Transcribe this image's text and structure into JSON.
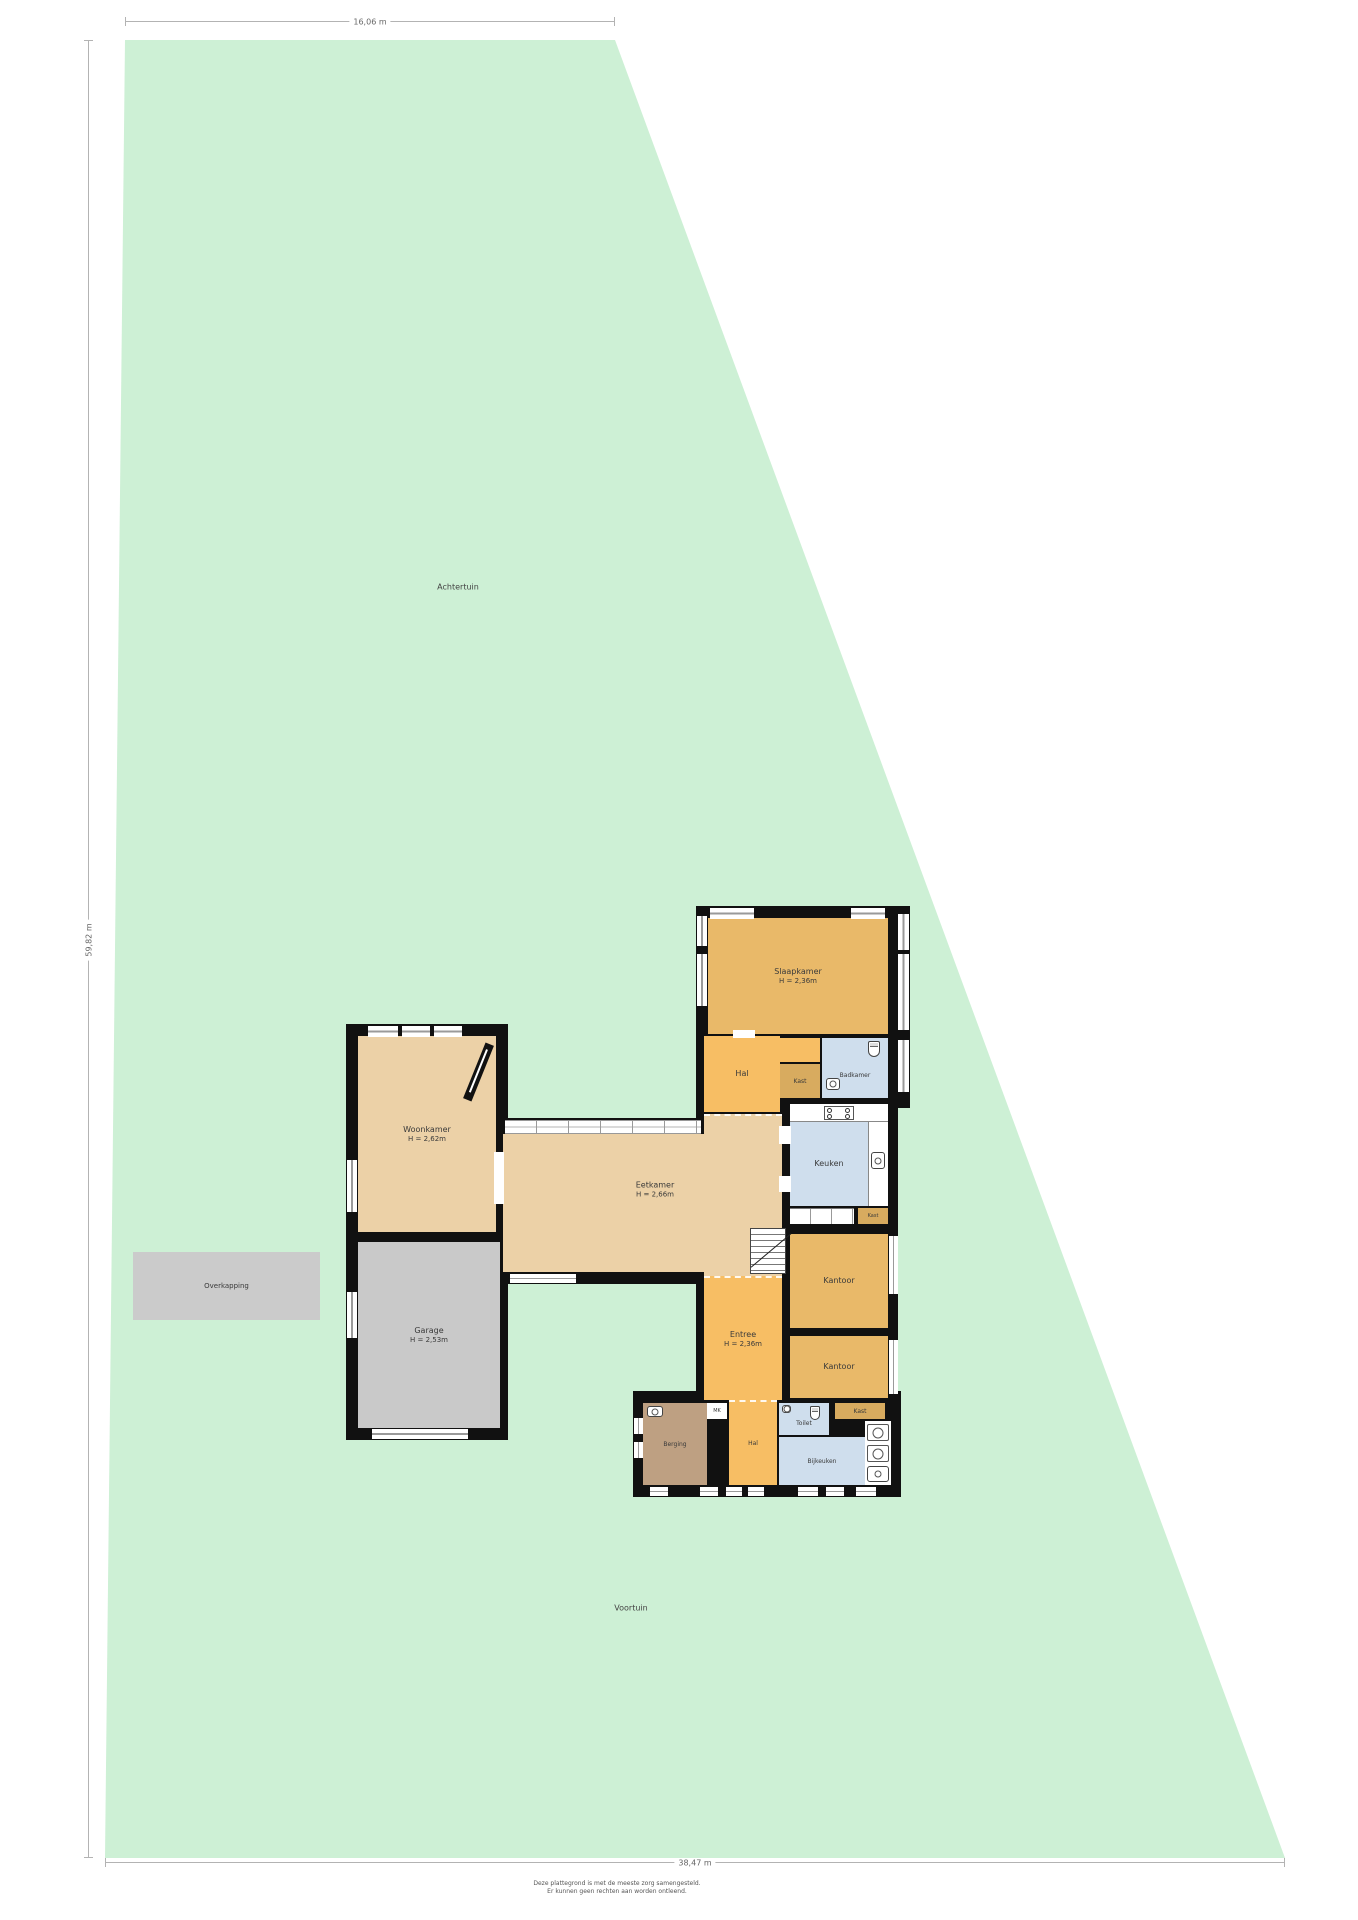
{
  "dimensions": {
    "top_width": "16,06 m",
    "left_height": "59,82 m",
    "bottom_width": "38,47 m"
  },
  "garden": {
    "back_garden": "Achtertuin",
    "front_garden": "Voortuin",
    "canopy": "Overkapping"
  },
  "rooms": {
    "slaapkamer": {
      "label": "Slaapkamer",
      "height": "H = 2,36m"
    },
    "hal_boven": {
      "label": "Hal"
    },
    "kast_boven": {
      "label": "Kast"
    },
    "badkamer": {
      "label": "Badkamer"
    },
    "keuken": {
      "label": "Keuken"
    },
    "kast_keuken": {
      "label": "Kast"
    },
    "kantoor_boven": {
      "label": "Kantoor"
    },
    "kantoor_onder": {
      "label": "Kantoor"
    },
    "eetkamer": {
      "label": "Eetkamer",
      "height": "H = 2,66m"
    },
    "woonkamer": {
      "label": "Woonkamer",
      "height": "H = 2,62m"
    },
    "garage": {
      "label": "Garage",
      "height": "H = 2,53m"
    },
    "entree": {
      "label": "Entree",
      "height": "H = 2,36m"
    },
    "berging": {
      "label": "Berging"
    },
    "meterkast": {
      "label": "MK"
    },
    "hal_beneden": {
      "label": "Hal"
    },
    "toilet": {
      "label": "Toilet"
    },
    "bijkeuken": {
      "label": "Bijkeuken"
    },
    "kast_beneden": {
      "label": "Kast"
    }
  },
  "footer": {
    "line1": "Deze plattegrond is met de meeste zorg samengesteld.",
    "line2": "Er kunnen geen rechten aan worden ontleend."
  },
  "colors": {
    "garden": "#cdf0d5",
    "walls": "#111111",
    "living_beige": "#ecd1a7",
    "hall_orange": "#f7be64",
    "room_orange": "#e9b969",
    "closet_tan": "#d8ab5f",
    "wet_blue": "#cfdeed",
    "garage_gray": "#c9c9c9",
    "storage_brown": "#bea082",
    "canopy_gray": "#cbcbcb"
  }
}
